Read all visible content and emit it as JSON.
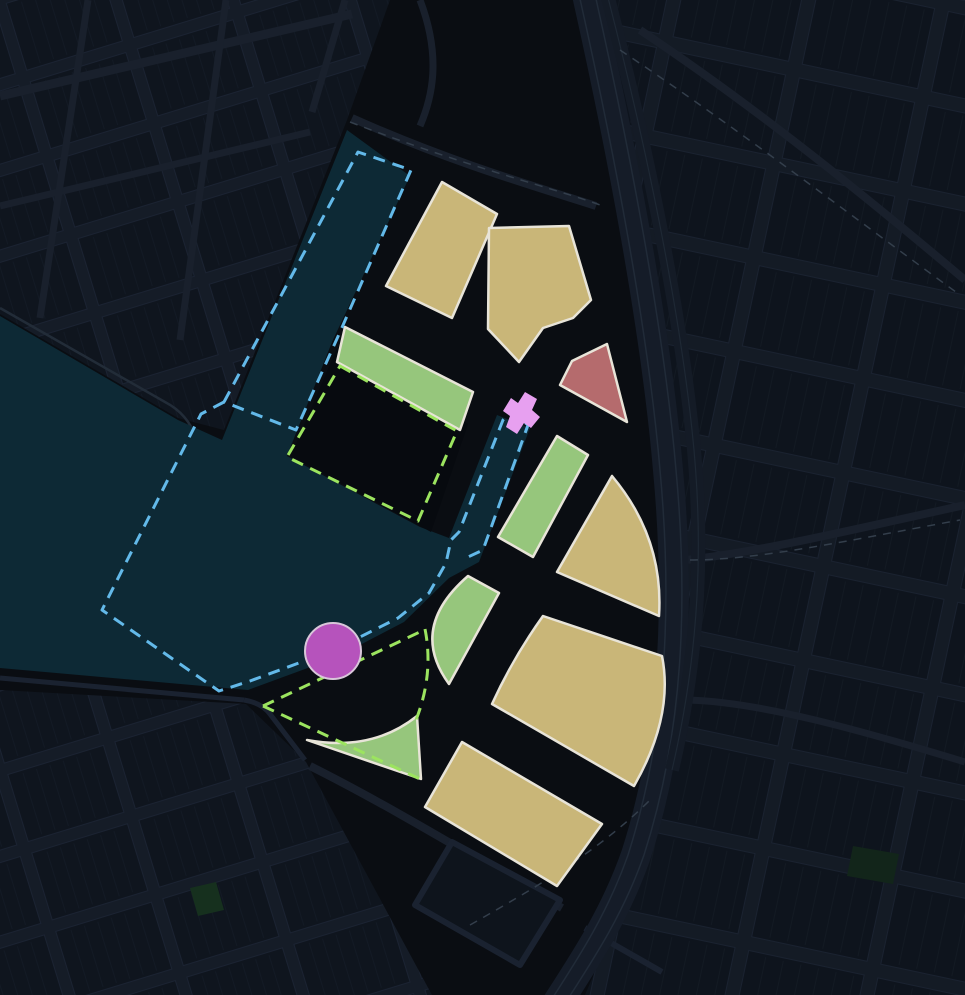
{
  "map": {
    "title": "dark-masterplan-map",
    "width": 965,
    "height": 995,
    "palette": {
      "background": "#0a0d12",
      "street": "#19202c",
      "block_fill": "#0f151e",
      "water": "#0d2935",
      "parcel_tan": "#c9b678",
      "parcel_green": "#96c67c",
      "parcel_red": "#b56b6d",
      "parcel_outline": "#e8e4d8",
      "boundary_blue_dash": "#63b9e9",
      "boundary_green_dash": "#9ce45f",
      "marker_magenta": "#b653bc",
      "marker_pink": "#e7a0f0"
    },
    "map_data": {
      "type": "masterplan-map",
      "layers": [
        {
          "name": "map-background",
          "type": "path",
          "d": "M0,0 H965 V995 H0 Z",
          "fill": "#0a0d12"
        },
        {
          "name": "district-top-left-blocks",
          "type": "path",
          "d": "M0,0 L390,0 L347,120 L224,430 L178,418 L0,314 Z",
          "fill": "url(#gridA)"
        },
        {
          "name": "district-right-blocks",
          "type": "path",
          "d": "M600,0 L965,0 L965,995 L585,995 C645,855 693,712 687,560 C680,408 645,190 600,0 Z",
          "fill": "url(#gridB)"
        },
        {
          "name": "district-bottom-left-blocks",
          "type": "path",
          "d": "M0,690 L246,704 L306,762 L432,995 L0,995 Z",
          "fill": "url(#gridA)"
        },
        {
          "name": "street-top-left-1",
          "type": "path",
          "d": "M0,96 L352,14",
          "stroke": "#19202c",
          "width": 9
        },
        {
          "name": "street-top-left-2",
          "type": "path",
          "d": "M0,206 L310,132",
          "stroke": "#19202c",
          "width": 7
        },
        {
          "name": "street-top-left-3",
          "type": "path",
          "d": "M88,0 L40,318",
          "stroke": "#19202c",
          "width": 7
        },
        {
          "name": "street-top-left-4",
          "type": "path",
          "d": "M226,0 L180,340",
          "stroke": "#19202c",
          "width": 7
        },
        {
          "name": "street-top-left-5",
          "type": "path",
          "d": "M345,0 L312,112",
          "stroke": "#19202c",
          "width": 7
        },
        {
          "name": "street-top-center-1",
          "type": "path",
          "d": "M352,118 C450,162 540,188 596,206",
          "stroke": "#19202c",
          "width": 8
        },
        {
          "name": "street-top-center-2",
          "type": "path",
          "d": "M420,0 C442,58 432,98 420,126",
          "stroke": "#19202c",
          "width": 7
        },
        {
          "name": "street-top-right-1",
          "type": "path",
          "d": "M640,30 C760,110 870,200 965,280",
          "stroke": "#19202c",
          "width": 8
        },
        {
          "name": "street-right-1",
          "type": "path",
          "d": "M686,560 C760,552 860,528 965,505",
          "stroke": "#19202c",
          "width": 8
        },
        {
          "name": "street-right-2",
          "type": "path",
          "d": "M688,700 C760,702 860,730 965,762",
          "stroke": "#19202c",
          "width": 7
        },
        {
          "name": "street-promenade-1",
          "type": "path",
          "d": "M0,678 L244,700",
          "stroke": "#1a2230",
          "width": 5
        },
        {
          "name": "street-promenade-2",
          "type": "path",
          "d": "M244,700 Q262,703 270,714 L305,760",
          "stroke": "#1a2230",
          "width": 5
        },
        {
          "name": "street-bottom-middle",
          "type": "path",
          "d": "M310,766 C390,806 475,858 562,908",
          "stroke": "#19202c",
          "width": 8
        },
        {
          "name": "street-bottom-right-loop-1",
          "type": "path",
          "d": "M452,842 L560,900 L520,965 L415,905 Z",
          "fill": "#0e141c",
          "stroke": "#1a2230",
          "width": 6
        },
        {
          "name": "street-bottom-right-loop-2",
          "type": "path",
          "d": "M585,928 L662,972",
          "stroke": "#1a2230",
          "width": 6
        },
        {
          "name": "ring-road-bed",
          "type": "path",
          "d": "M586,-10 C622,150 656,330 668,470 C680,600 676,730 636,855 C615,915 585,960 556,1005",
          "stroke": "#151c28",
          "width": 30
        },
        {
          "name": "ring-road-lane-left",
          "type": "path",
          "d": "M586,-10 C622,150 656,330 668,470 C680,600 676,730 636,855 C615,915 585,960 556,1005",
          "stroke": "#212b38",
          "width": 1.5,
          "transform": "translate(-8,0)"
        },
        {
          "name": "ring-road-lane-right",
          "type": "path",
          "d": "M586,-10 C622,150 656,330 668,470 C680,600 676,730 636,855 C615,915 585,960 556,1005",
          "stroke": "#212b38",
          "width": 1.5,
          "transform": "translate(8,0)"
        },
        {
          "name": "ring-road-2-bed",
          "type": "path",
          "d": "M606,-10 C645,140 678,300 692,430 C704,540 700,650 672,770",
          "stroke": "#141b26",
          "width": 14
        },
        {
          "name": "ring-road-2-lane",
          "type": "path",
          "d": "M606,-10 C645,140 678,300 692,430 C704,540 700,650 672,770",
          "stroke": "#1e2834",
          "width": 1.2
        },
        {
          "name": "basemap-dash-1",
          "type": "path",
          "d": "M350,122 C470,168 560,190 600,205",
          "stroke": "#333e4b",
          "width": 1.5,
          "dash": "8 7"
        },
        {
          "name": "basemap-dash-2",
          "type": "path",
          "d": "M620,50 C740,130 850,215 960,295",
          "stroke": "#333e4b",
          "width": 1.5,
          "dash": "8 7"
        },
        {
          "name": "basemap-dash-3",
          "type": "path",
          "d": "M690,560 C760,560 850,540 960,520",
          "stroke": "#333e4b",
          "width": 1.5,
          "dash": "8 7"
        },
        {
          "name": "basemap-dash-4",
          "type": "path",
          "d": "M470,925 C540,885 600,850 650,800",
          "stroke": "#333e4b",
          "width": 1.5,
          "dash": "8 7"
        },
        {
          "name": "park-patch-small-left",
          "type": "path",
          "d": "M190,888 l26,-6 l8,28 l-26,6 Z",
          "fill": "#16301e"
        },
        {
          "name": "park-patch-small-right",
          "type": "path",
          "d": "M853,846 l46,8 l-6,30 l-46,-8 Z",
          "fill": "#12251a"
        },
        {
          "name": "shoreline-street-edge",
          "type": "path",
          "d": "M0,308 L165,402 Q188,414 196,438 L210,478",
          "stroke": "#222c38",
          "width": 2.5
        },
        {
          "name": "water-dock-basin-canal",
          "type": "path",
          "d": "M0,316 L178,420 L222,440 L347,130 L410,176 L332,342 L287,456 L420,527 L449,538 L497,415 L530,428 L479,562 L449,578 L404,622 L335,658 L248,690 L0,668 Z",
          "fill": "#0d2935"
        },
        {
          "name": "central-dark-block",
          "type": "path",
          "d": "M337,348 L468,424 L431,532 L291,456 Z",
          "fill": "#070a0f"
        },
        {
          "name": "parcel-green-north-strip",
          "type": "path",
          "d": "M345,327 L473,392 L460,430 L337,362 Z",
          "fill": "#96c67c",
          "stroke": "#e8e4d8",
          "width": 2.5
        },
        {
          "name": "parcel-tan-northwest",
          "type": "path",
          "d": "M442,182 L497,214 L452,318 L386,286 Z",
          "fill": "#c9b678",
          "stroke": "#e8e4d8",
          "width": 2.5
        },
        {
          "name": "parcel-tan-north-notched",
          "type": "path",
          "d": "M489,228 L569,226 L591,300 L573,318 L543,328 L519,362 L488,329 Z",
          "fill": "#c9b678",
          "stroke": "#e8e4d8",
          "width": 2.5
        },
        {
          "name": "parcel-red-triangle",
          "type": "path",
          "d": "M607,344 L572,361 L560,385 L627,422 Z",
          "fill": "#b56b6d",
          "stroke": "#e8e4d8",
          "width": 2.5
        },
        {
          "name": "parcel-green-canal-east",
          "type": "path",
          "d": "M557,436 L588,455 L533,557 L498,537 Z",
          "fill": "#96c67c",
          "stroke": "#e8e4d8",
          "width": 2.5
        },
        {
          "name": "parcel-tan-east-triangle",
          "type": "path",
          "d": "M612,476 L557,572 L659,616 Q664,538 612,476 Z",
          "fill": "#c9b678",
          "stroke": "#e8e4d8",
          "width": 2.5
        },
        {
          "name": "parcel-tan-east-large",
          "type": "path",
          "d": "M543,616 L662,656 Q674,716 634,786 L492,704 Q513,658 543,616 Z",
          "fill": "#c9b678",
          "stroke": "#e8e4d8",
          "width": 2.5
        },
        {
          "name": "parcel-tan-south",
          "type": "path",
          "d": "M462,742 L602,824 L557,886 L425,807 Z",
          "fill": "#c9b678",
          "stroke": "#e8e4d8",
          "width": 2.5
        },
        {
          "name": "parcel-green-plaza-northeast",
          "type": "path",
          "d": "M468,576 L499,593 L449,684 Q408,628 468,576 Z",
          "fill": "#96c67c",
          "stroke": "#e8e4d8",
          "width": 2.5
        },
        {
          "name": "parcel-green-plaza-south",
          "type": "path",
          "d": "M307,740 Q372,752 417,716 L421,779 Z",
          "fill": "#96c67c",
          "stroke": "#e8e4d8",
          "width": 2.5
        },
        {
          "name": "site-boundary-blue-dock-strip",
          "type": "path",
          "d": "M224,402 L358,152 L411,170 L340,332 L296,430 Z",
          "stroke": "#63b9e9",
          "width": 3,
          "dash": "12 8"
        },
        {
          "name": "site-boundary-blue-basin-canal",
          "type": "path",
          "d": "M224,402 L201,414 L102,610 L219,691 L250,681 L334,650 L398,618 L429,593 L446,563 L451,540 L459,532 L503,420 L512,412 L528,425 L483,550 L468,557",
          "stroke": "#63b9e9",
          "width": 3,
          "dash": "12 8"
        },
        {
          "name": "green-outline-central-block",
          "type": "path",
          "d": "M340,366 L457,431 L418,521 L287,457 Z",
          "stroke": "#9ce45f",
          "width": 3,
          "dash": "12 8"
        },
        {
          "name": "green-view-cone-upper-edge",
          "type": "path",
          "d": "M263,706 L424,630",
          "stroke": "#9ce45f",
          "width": 3,
          "dash": "12 8"
        },
        {
          "name": "green-view-cone-arc",
          "type": "path",
          "d": "M425,629 Q434,674 416,720",
          "stroke": "#9ce45f",
          "width": 3,
          "dash": "12 8"
        },
        {
          "name": "green-view-cone-lower-edge",
          "type": "path",
          "d": "M263,706 L420,779",
          "stroke": "#9ce45f",
          "width": 3,
          "dash": "12 8"
        },
        {
          "name": "magenta-circle-marker",
          "type": "circle",
          "cx": 333,
          "cy": 651,
          "r": 28,
          "fill": "#b653bc",
          "stroke": "#d9c6da",
          "width": 2
        },
        {
          "name": "pink-structure-marker",
          "type": "path",
          "d": "M506,427 L517,434 L524,423 L531,428 L540,417 L532,410 L537,399 L525,392 L518,403 L511,398 L503,411 L510,416 Z",
          "fill": "#e7a0f0"
        }
      ]
    }
  }
}
